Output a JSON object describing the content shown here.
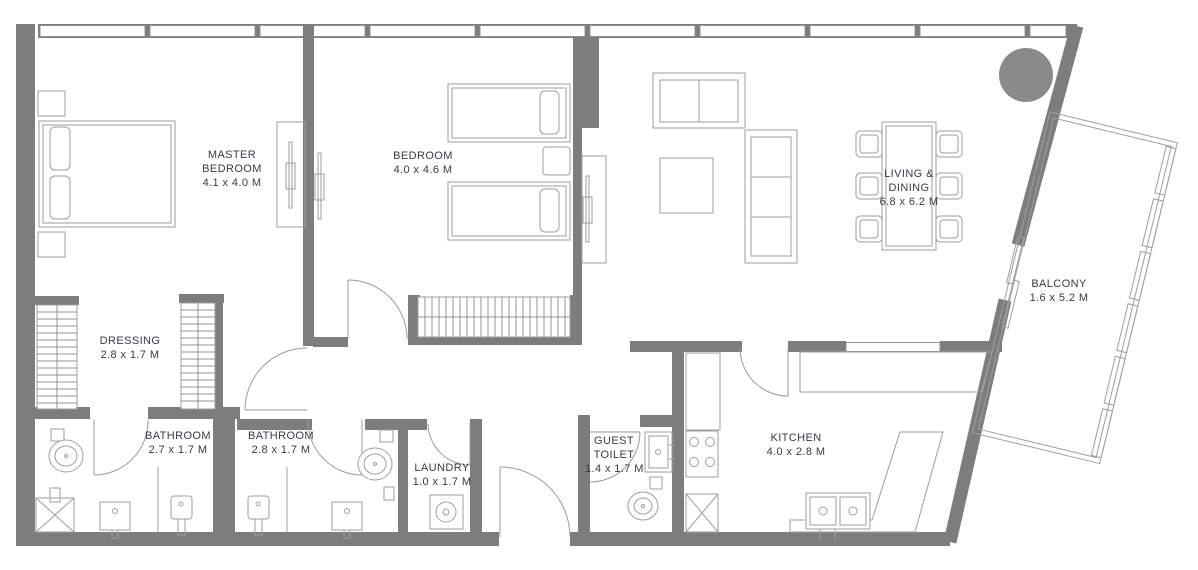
{
  "plan": {
    "title": "Apartment floor plan",
    "rooms": [
      {
        "id": "master-bedroom",
        "name": "MASTER BEDROOM",
        "dims": "4.1 x 4.0 M"
      },
      {
        "id": "bedroom",
        "name": "BEDROOM",
        "dims": "4.0 x 4.6 M"
      },
      {
        "id": "living-dining",
        "name": "LIVING & DINING",
        "dims": "6.8 x 6.2 M"
      },
      {
        "id": "balcony",
        "name": "BALCONY",
        "dims": "1.6 x 5.2 M"
      },
      {
        "id": "dressing",
        "name": "DRESSING",
        "dims": "2.8 x 1.7 M"
      },
      {
        "id": "bathroom-master",
        "name": "BATHROOM",
        "dims": "2.7 x 1.7 M"
      },
      {
        "id": "bathroom-2",
        "name": "BATHROOM",
        "dims": "2.8 x 1.7 M"
      },
      {
        "id": "laundry",
        "name": "LAUNDRY",
        "dims": "1.0 x 1.7 M"
      },
      {
        "id": "guest-toilet",
        "name": "GUEST TOILET",
        "dims": "1.4 x 1.7 M"
      },
      {
        "id": "kitchen",
        "name": "KITCHEN",
        "dims": "4.0 x 2.8 M"
      }
    ],
    "colors": {
      "wall": "#7d7d7d",
      "furniture_line": "#9e9e9e",
      "text": "#3a3a42",
      "background": "#ffffff",
      "column_fill": "#8a8a8a"
    }
  }
}
